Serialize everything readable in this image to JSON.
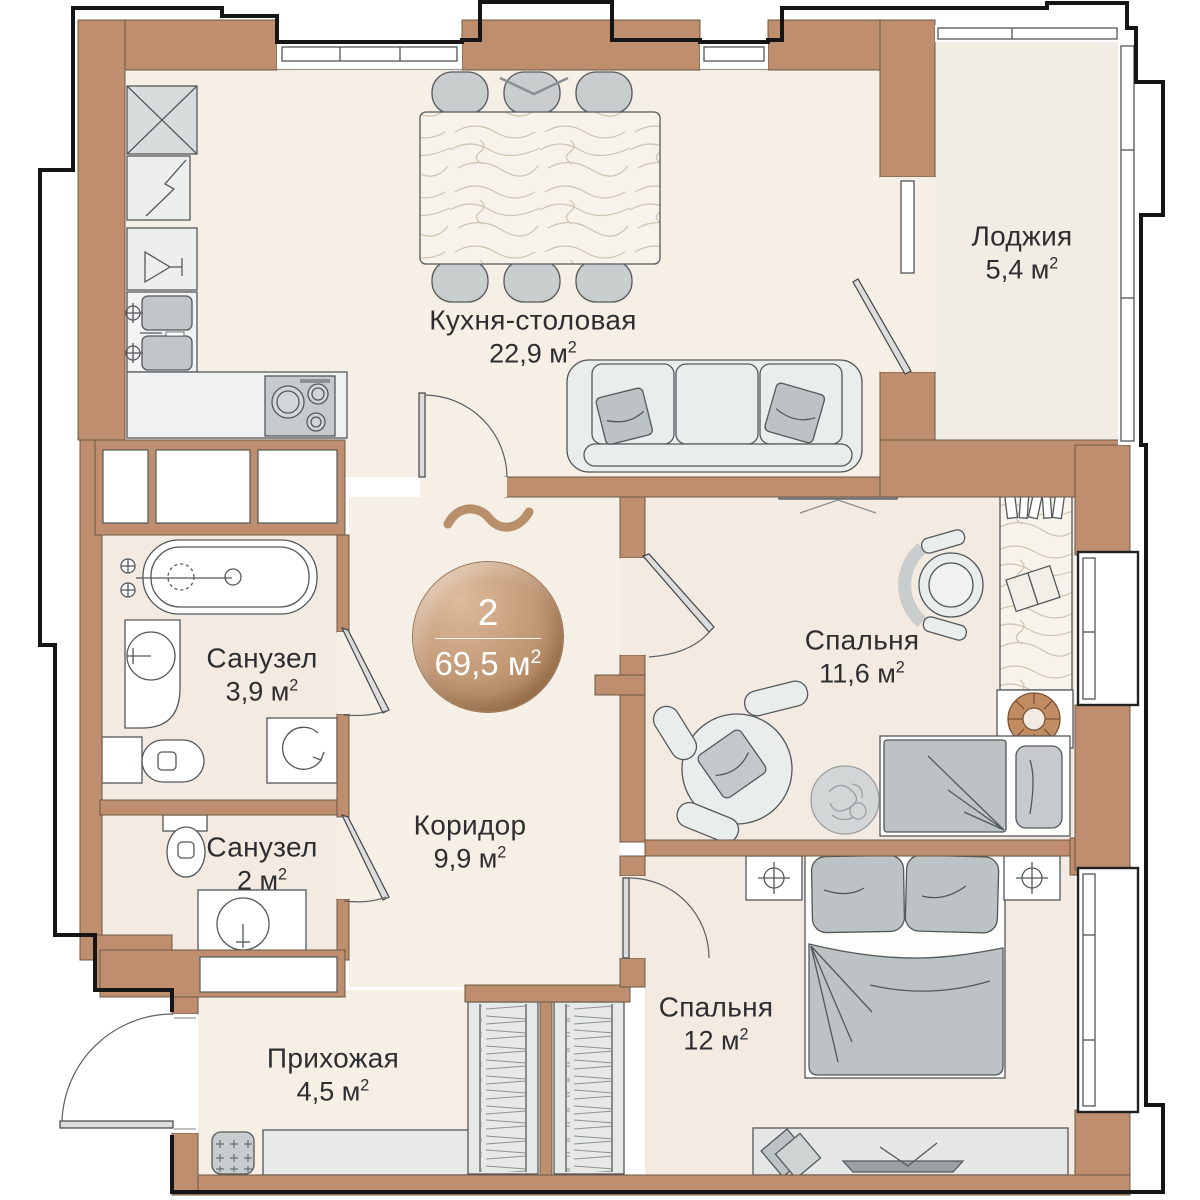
{
  "units": {
    "meter": "м",
    "power": "2"
  },
  "badge": {
    "rooms_count": "2",
    "total_area": "69,5"
  },
  "rooms": [
    {
      "key": "kitchen",
      "name": "Кухня-столовая",
      "area": "22,9"
    },
    {
      "key": "loggia",
      "name": "Лоджия",
      "area": "5,4"
    },
    {
      "key": "bedroom1",
      "name": "Спальня",
      "area": "11,6"
    },
    {
      "key": "bathroom1",
      "name": "Санузел",
      "area": "3,9"
    },
    {
      "key": "bathroom2",
      "name": "Санузел",
      "area": "2"
    },
    {
      "key": "corridor",
      "name": "Коридор",
      "area": "9,9"
    },
    {
      "key": "hallway",
      "name": "Прихожая",
      "area": "4,5"
    },
    {
      "key": "bedroom2",
      "name": "Спальня",
      "area": "12"
    }
  ],
  "colors": {
    "wall": "#BE8E6E",
    "outline": "#151515",
    "floor": "#F5EFE6",
    "floor_bedrooms": "#F3EAE1",
    "floor_loggia": "#F1EDE4",
    "furniture_fill": "#E9EDEC",
    "furniture_stroke": "#53585B",
    "soft_gray": "#BDC2C5",
    "badge_gradient_start": "#DDBB9C",
    "badge_gradient_end": "#A0774F",
    "accent_brown": "#B98F6B",
    "text": "#2E2E31"
  }
}
